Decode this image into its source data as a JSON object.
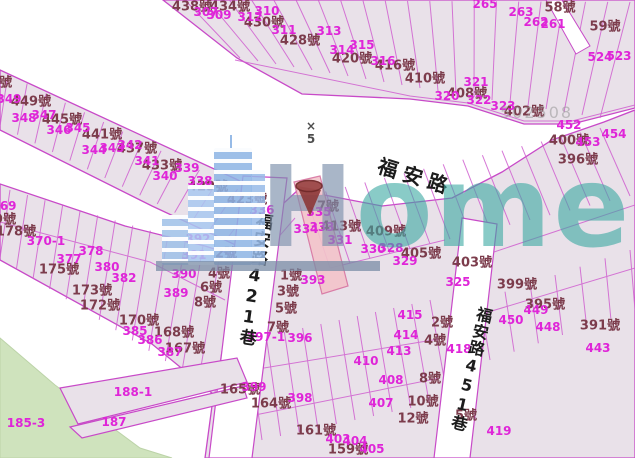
{
  "map": {
    "streets": {
      "main": "福安路",
      "lane421": "福安路421巷",
      "lane451": "福安路451巷"
    },
    "marker": {
      "cross": "×",
      "number": "5"
    },
    "watermark": {
      "brand_first": "H",
      "brand_rest": "ome",
      "code": "502508"
    },
    "colors": {
      "parcel_fill": "#e9e1e9",
      "parcel_stroke": "#c84ac8",
      "address_text": "#7c3c4c",
      "lot_text": "#df25d8",
      "street_text": "#1c1c1c",
      "park_green": "#cfe3bd",
      "highlight_parcel": "#f3c4ca",
      "pin": "#8d3a3a",
      "watermark_blue": "#7c90ac",
      "watermark_teal": "#3aa8a2"
    },
    "addresses": [
      {
        "t": "438號",
        "x": 192,
        "y": 5
      },
      {
        "t": "434號",
        "x": 230,
        "y": 5
      },
      {
        "t": "430號",
        "x": 264,
        "y": 21
      },
      {
        "t": "428號",
        "x": 300,
        "y": 39
      },
      {
        "t": "420號",
        "x": 352,
        "y": 57
      },
      {
        "t": "416號",
        "x": 395,
        "y": 64
      },
      {
        "t": "58號",
        "x": 560,
        "y": 6
      },
      {
        "t": "59號",
        "x": 605,
        "y": 25
      },
      {
        "t": "410號",
        "x": 425,
        "y": 77
      },
      {
        "t": "408號",
        "x": 467,
        "y": 92
      },
      {
        "t": "402號",
        "x": 524,
        "y": 110
      },
      {
        "t": "400號",
        "x": 569,
        "y": 139
      },
      {
        "t": "396號",
        "x": 578,
        "y": 158
      },
      {
        "t": "453號",
        "x": -8,
        "y": 81
      },
      {
        "t": "449號",
        "x": 31,
        "y": 100
      },
      {
        "t": "445號",
        "x": 62,
        "y": 118
      },
      {
        "t": "441號",
        "x": 102,
        "y": 133
      },
      {
        "t": "437號",
        "x": 137,
        "y": 147
      },
      {
        "t": "433號",
        "x": 162,
        "y": 164
      },
      {
        "t": "429號",
        "x": 208,
        "y": 185
      },
      {
        "t": "423號",
        "x": 247,
        "y": 198
      },
      {
        "t": "179號",
        "x": -4,
        "y": 218
      },
      {
        "t": "178號",
        "x": 16,
        "y": 230
      },
      {
        "t": "175號",
        "x": 59,
        "y": 268
      },
      {
        "t": "173號",
        "x": 92,
        "y": 289
      },
      {
        "t": "172號",
        "x": 100,
        "y": 304
      },
      {
        "t": "170號",
        "x": 139,
        "y": 319
      },
      {
        "t": "168號",
        "x": 174,
        "y": 331
      },
      {
        "t": "167號",
        "x": 185,
        "y": 347
      },
      {
        "t": "2號",
        "x": 226,
        "y": 252
      },
      {
        "t": "4號",
        "x": 219,
        "y": 272
      },
      {
        "t": "6號",
        "x": 211,
        "y": 286
      },
      {
        "t": "8號",
        "x": 205,
        "y": 301
      },
      {
        "t": "1號",
        "x": 291,
        "y": 274
      },
      {
        "t": "3號",
        "x": 288,
        "y": 290
      },
      {
        "t": "5號",
        "x": 286,
        "y": 307
      },
      {
        "t": "7號",
        "x": 278,
        "y": 326
      },
      {
        "t": "7號",
        "x": 328,
        "y": 205
      },
      {
        "t": "413號",
        "x": 341,
        "y": 225
      },
      {
        "t": "409號",
        "x": 386,
        "y": 230
      },
      {
        "t": "405號",
        "x": 421,
        "y": 252
      },
      {
        "t": "403號",
        "x": 472,
        "y": 261
      },
      {
        "t": "399號",
        "x": 517,
        "y": 283
      },
      {
        "t": "395號",
        "x": 545,
        "y": 303
      },
      {
        "t": "391號",
        "x": 600,
        "y": 324
      },
      {
        "t": "165號",
        "x": 240,
        "y": 388
      },
      {
        "t": "164號",
        "x": 271,
        "y": 402
      },
      {
        "t": "161號",
        "x": 316,
        "y": 429
      },
      {
        "t": "159號",
        "x": 348,
        "y": 448
      },
      {
        "t": "2號",
        "x": 442,
        "y": 321
      },
      {
        "t": "4號",
        "x": 435,
        "y": 339
      },
      {
        "t": "8號",
        "x": 430,
        "y": 377
      },
      {
        "t": "10號",
        "x": 423,
        "y": 400
      },
      {
        "t": "12號",
        "x": 413,
        "y": 417
      },
      {
        "t": "5號",
        "x": 466,
        "y": 414
      }
    ],
    "lots": [
      {
        "t": "307",
        "x": 206,
        "y": 12
      },
      {
        "t": "309",
        "x": 219,
        "y": 15
      },
      {
        "t": "310",
        "x": 267,
        "y": 11
      },
      {
        "t": "312",
        "x": 250,
        "y": 17
      },
      {
        "t": "311",
        "x": 284,
        "y": 30
      },
      {
        "t": "313",
        "x": 329,
        "y": 31
      },
      {
        "t": "314",
        "x": 342,
        "y": 50
      },
      {
        "t": "315",
        "x": 362,
        "y": 45
      },
      {
        "t": "316",
        "x": 383,
        "y": 61
      },
      {
        "t": "265",
        "x": 485,
        "y": 4
      },
      {
        "t": "263",
        "x": 521,
        "y": 12
      },
      {
        "t": "262",
        "x": 536,
        "y": 22
      },
      {
        "t": "261",
        "x": 553,
        "y": 24
      },
      {
        "t": "524",
        "x": 600,
        "y": 57
      },
      {
        "t": "523",
        "x": 619,
        "y": 56
      },
      {
        "t": "320",
        "x": 447,
        "y": 96
      },
      {
        "t": "321",
        "x": 476,
        "y": 82
      },
      {
        "t": "322",
        "x": 479,
        "y": 100
      },
      {
        "t": "323",
        "x": 503,
        "y": 106
      },
      {
        "t": "452",
        "x": 569,
        "y": 125
      },
      {
        "t": "453",
        "x": 588,
        "y": 142
      },
      {
        "t": "454",
        "x": 614,
        "y": 134
      },
      {
        "t": "349",
        "x": 9,
        "y": 99
      },
      {
        "t": "348",
        "x": 24,
        "y": 118
      },
      {
        "t": "347",
        "x": 44,
        "y": 115
      },
      {
        "t": "346",
        "x": 59,
        "y": 130
      },
      {
        "t": "345",
        "x": 78,
        "y": 128
      },
      {
        "t": "344",
        "x": 94,
        "y": 150
      },
      {
        "t": "343",
        "x": 112,
        "y": 148
      },
      {
        "t": "342",
        "x": 130,
        "y": 145
      },
      {
        "t": "341",
        "x": 147,
        "y": 161
      },
      {
        "t": "340",
        "x": 165,
        "y": 176
      },
      {
        "t": "339",
        "x": 187,
        "y": 168
      },
      {
        "t": "338",
        "x": 200,
        "y": 181
      },
      {
        "t": "336",
        "x": 262,
        "y": 210
      },
      {
        "t": "335",
        "x": 319,
        "y": 212
      },
      {
        "t": "334",
        "x": 306,
        "y": 229
      },
      {
        "t": "333",
        "x": 322,
        "y": 227
      },
      {
        "t": "331",
        "x": 340,
        "y": 240
      },
      {
        "t": "330",
        "x": 373,
        "y": 249
      },
      {
        "t": "328",
        "x": 391,
        "y": 248
      },
      {
        "t": "329",
        "x": 405,
        "y": 261
      },
      {
        "t": "325",
        "x": 458,
        "y": 282
      },
      {
        "t": "369",
        "x": 4,
        "y": 206
      },
      {
        "t": "370-1",
        "x": 46,
        "y": 241
      },
      {
        "t": "378",
        "x": 91,
        "y": 251
      },
      {
        "t": "377",
        "x": 69,
        "y": 259
      },
      {
        "t": "380",
        "x": 107,
        "y": 267
      },
      {
        "t": "382",
        "x": 124,
        "y": 278
      },
      {
        "t": "385",
        "x": 135,
        "y": 331
      },
      {
        "t": "386",
        "x": 150,
        "y": 340
      },
      {
        "t": "387",
        "x": 170,
        "y": 352
      },
      {
        "t": "389",
        "x": 176,
        "y": 293
      },
      {
        "t": "390",
        "x": 184,
        "y": 274
      },
      {
        "t": "391",
        "x": 194,
        "y": 255
      },
      {
        "t": "392",
        "x": 198,
        "y": 239
      },
      {
        "t": "393",
        "x": 313,
        "y": 280
      },
      {
        "t": "397-1",
        "x": 266,
        "y": 337
      },
      {
        "t": "396",
        "x": 300,
        "y": 338
      },
      {
        "t": "398",
        "x": 300,
        "y": 398
      },
      {
        "t": "399",
        "x": 254,
        "y": 387
      },
      {
        "t": "403",
        "x": 338,
        "y": 439
      },
      {
        "t": "404",
        "x": 355,
        "y": 441
      },
      {
        "t": "405",
        "x": 372,
        "y": 449
      },
      {
        "t": "407",
        "x": 381,
        "y": 403
      },
      {
        "t": "408",
        "x": 391,
        "y": 380
      },
      {
        "t": "410",
        "x": 366,
        "y": 361
      },
      {
        "t": "413",
        "x": 399,
        "y": 351
      },
      {
        "t": "414",
        "x": 406,
        "y": 335
      },
      {
        "t": "415",
        "x": 410,
        "y": 315
      },
      {
        "t": "418",
        "x": 459,
        "y": 349
      },
      {
        "t": "443",
        "x": 598,
        "y": 348
      },
      {
        "t": "448",
        "x": 548,
        "y": 327
      },
      {
        "t": "449",
        "x": 536,
        "y": 310
      },
      {
        "t": "450",
        "x": 511,
        "y": 320
      },
      {
        "t": "419",
        "x": 499,
        "y": 431
      },
      {
        "t": "185-3",
        "x": 26,
        "y": 423
      },
      {
        "t": "188-1",
        "x": 133,
        "y": 392
      },
      {
        "t": "187",
        "x": 114,
        "y": 422
      }
    ]
  }
}
